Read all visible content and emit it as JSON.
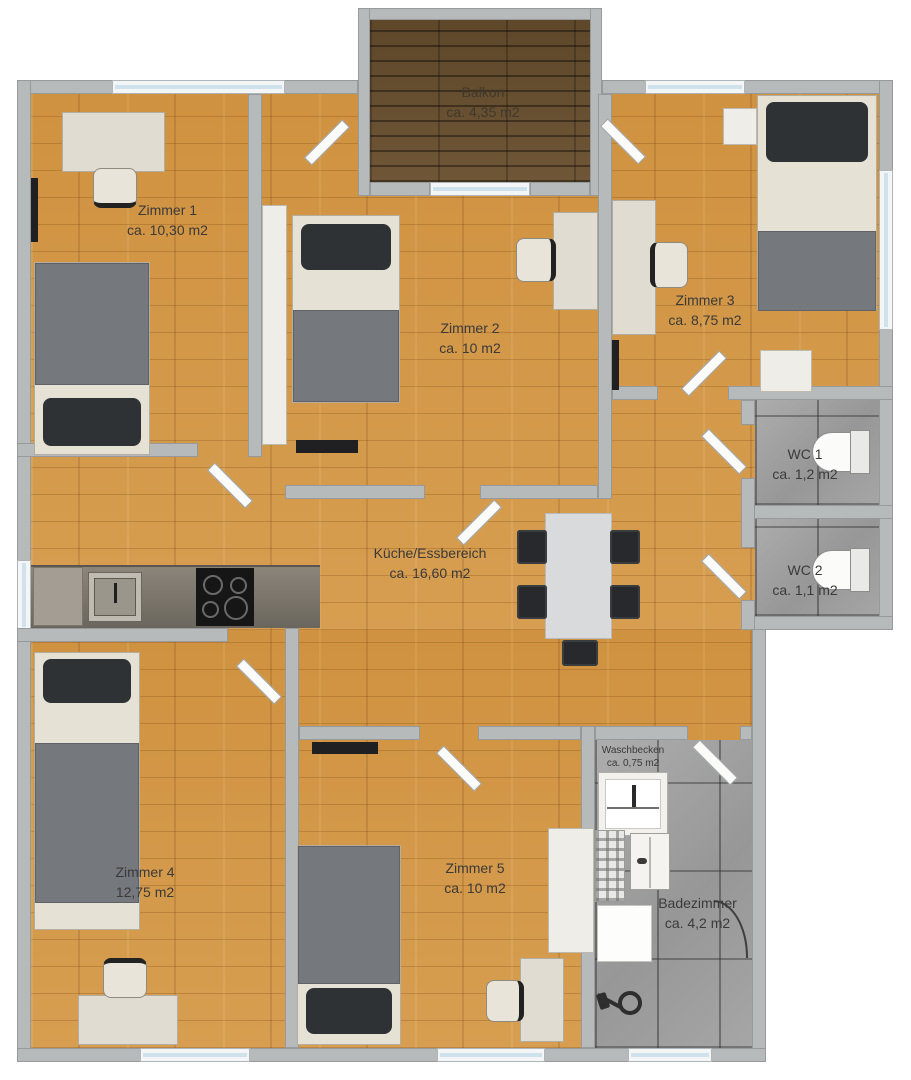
{
  "plan_title": "Apartment floor plan",
  "rooms": {
    "balkon": {
      "name": "Balkon",
      "area": "ca. 4,35 m2"
    },
    "zimmer1": {
      "name": "Zimmer 1",
      "area": "ca. 10,30 m2"
    },
    "zimmer2": {
      "name": "Zimmer 2",
      "area": "ca. 10 m2"
    },
    "zimmer3": {
      "name": "Zimmer 3",
      "area": "ca. 8,75 m2"
    },
    "wc1": {
      "name": "WC 1",
      "area": "ca. 1,2 m2"
    },
    "wc2": {
      "name": "WC 2",
      "area": "ca. 1,1 m2"
    },
    "kueche": {
      "name": "Küche/Essbereich",
      "area": "ca. 16,60 m2"
    },
    "zimmer4": {
      "name": "Zimmer 4",
      "area": "12,75 m2"
    },
    "zimmer5": {
      "name": "Zimmer 5",
      "area": "ca. 10 m2"
    },
    "waschbecken": {
      "name": "Waschbecken",
      "area": "ca. 0,75 m2"
    },
    "badezimmer": {
      "name": "Badezimmer",
      "area": "ca. 4,2 m2"
    }
  },
  "colors": {
    "floor_wood": "#d59a4b",
    "balcony_wood": "#6b5334",
    "tile": "#a3a3a3",
    "wall": "#b7baba",
    "window_glass": "#cfe2eb",
    "furniture_light": "#e6e1d5",
    "furniture_dark": "#2f3235",
    "label_text": "#3a3a3a"
  }
}
